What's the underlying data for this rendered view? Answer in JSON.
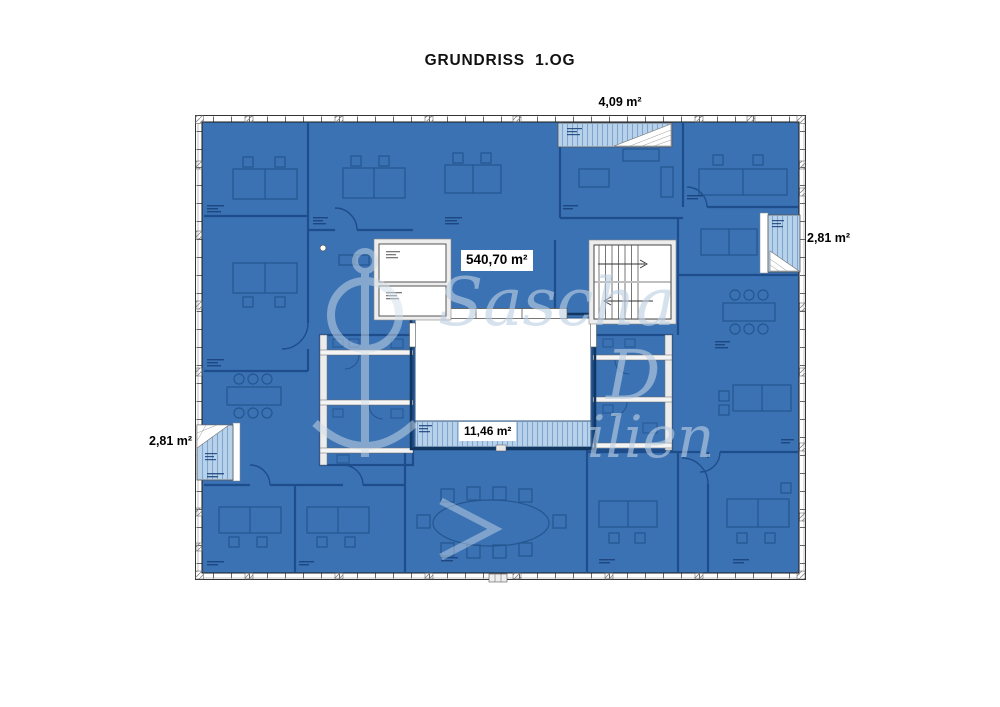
{
  "title": "GRUNDRISS  1.OG",
  "plan": {
    "name": "floor-plan-grundriss-1og",
    "area_labels": {
      "main": "540,70 m²",
      "atrium_balcony": "11,46 m²",
      "loggia_top": "4,09 m²",
      "loggia_right": "2,81 m²",
      "loggia_left": "2,81 m²"
    },
    "watermark": {
      "part1": "Sascha",
      "part2": "D",
      "part3": "ilien"
    },
    "colors": {
      "room_fill": "#3b72b4",
      "wall_line": "#1e4d8b",
      "loggia_fill": "#b8d2ea",
      "watermark": "#bccfe2"
    }
  }
}
